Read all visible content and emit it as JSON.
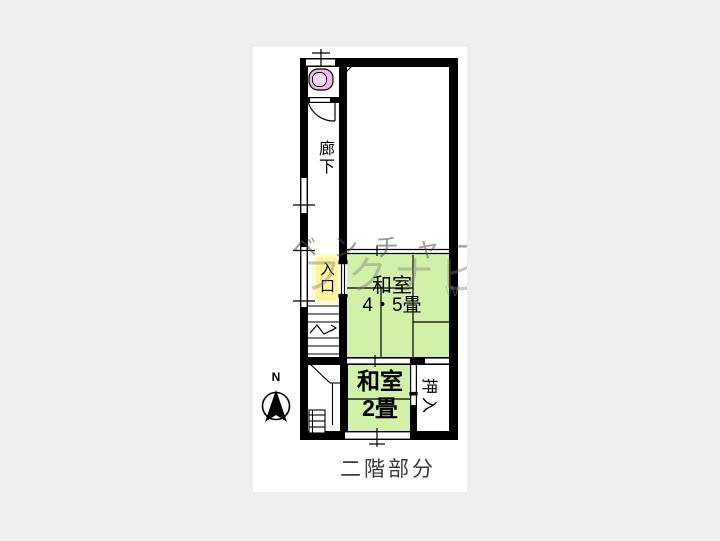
{
  "plan": {
    "caption": "二階部分",
    "compass": {
      "label": "N"
    },
    "rooms": {
      "corridor": {
        "label": "廊下"
      },
      "entrance": {
        "label": "入口"
      },
      "tatami_45": {
        "label": "和室",
        "size": "4・5畳"
      },
      "tatami_2": {
        "label": "和室",
        "size": "2畳"
      },
      "closet": {
        "label": "押入"
      }
    },
    "watermark": {
      "line1": "ベンチャー",
      "line2": "フクナビ",
      "line3": "W"
    },
    "colors": {
      "wall": "#000000",
      "tatami_green": "#d2f0a8",
      "toilet_pink": "#f2bce8",
      "toilet_pink_light": "#f8dbf3",
      "entrance_yellow": "#fdf59d",
      "sheet": "#ffffff",
      "background": "#efefef",
      "caption_text": "#3d3d3d"
    }
  }
}
